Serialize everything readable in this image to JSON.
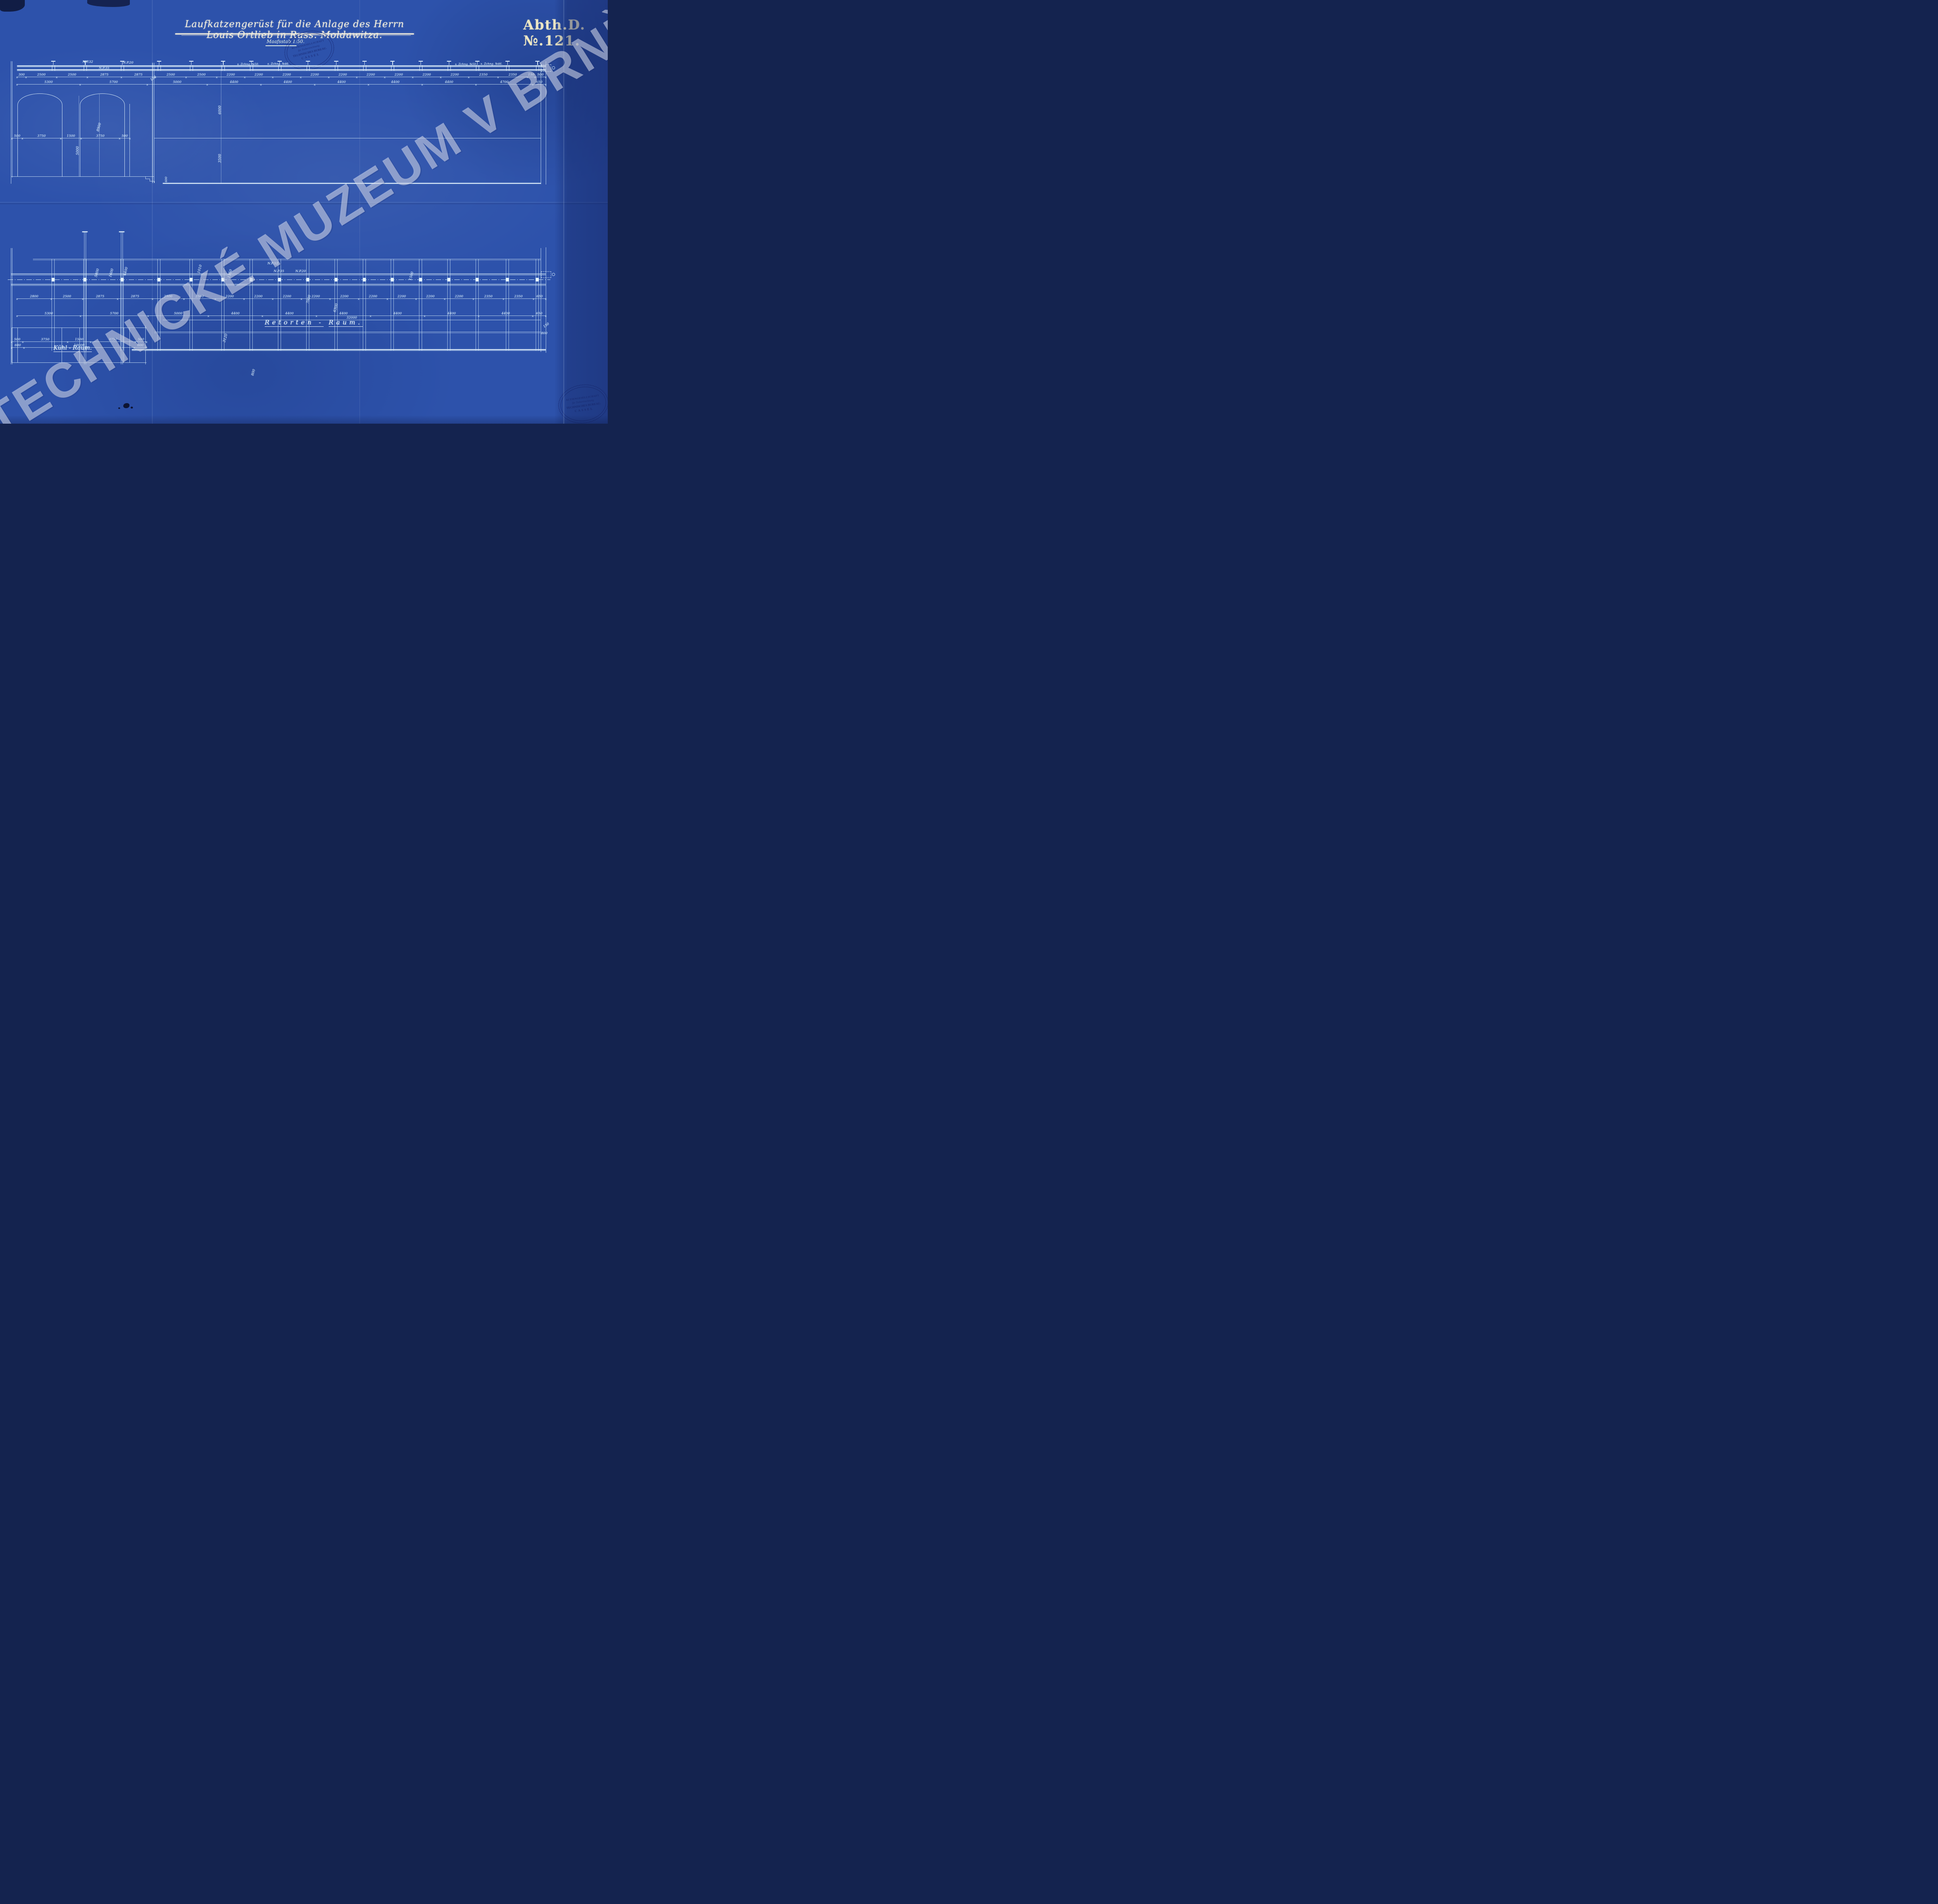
{
  "page": {
    "title": "Laufkatzengerüst für die Anlage des Herrn Louis Ortlieb in Russ. Moldawitza.",
    "drawing_number": "Abth.D.№.121.",
    "scale_note": "Maafsstab 1:50.",
    "watermark": "TECHNICKÉ MUZEUM V BRNĚ"
  },
  "stamp": {
    "line1": "ACTIENGESELLSCHAFT",
    "line2": "für Trebertrocknung",
    "line3": "TECHNISCHES BUREAU.",
    "line4": "CASSEL"
  },
  "elevation": {
    "beam_label_np32": "N.P.32",
    "beam_label_np35": "N.P.35",
    "beam_label_np20": "N.P.20",
    "ref_note_50": "s. Zchng. №50.",
    "ref_note_46": "s. Zchng. №46.",
    "dims_upper": [
      "300",
      "2500",
      "2500",
      "2875",
      "2875",
      "2500",
      "2500",
      "2200",
      "2200",
      "2200",
      "2200",
      "2200",
      "2200",
      "2200",
      "2200",
      "2200",
      "2350",
      "2350",
      "150",
      "500"
    ],
    "dims_lower": [
      "5300",
      "5700",
      "5000",
      "4400",
      "4400",
      "4400",
      "4400",
      "4400",
      "4700",
      "650"
    ],
    "offset_150": "150",
    "height_above_rail": "6000",
    "height_below_rail": "3500",
    "step_height": "600",
    "section": {
      "dims": [
        "500",
        "3750",
        "1500",
        "3750",
        "500"
      ],
      "arch_height": "8900",
      "clear_height": "5000"
    }
  },
  "plan": {
    "beam_label_np32": "N.P.32",
    "beam_label_np35": "N.P.35",
    "beam_label_np20": "N.P.20",
    "dims_upper": [
      "2800",
      "2500",
      "2875",
      "2875",
      "2500",
      "2500",
      "2200",
      "2200",
      "2200",
      "2200",
      "2200",
      "2200",
      "2200",
      "2200",
      "2200",
      "2350",
      "2350",
      "650"
    ],
    "dims_mid": [
      "5300",
      "5700",
      "5000",
      "4400",
      "4400",
      "4400",
      "4400",
      "4400",
      "4400",
      "650"
    ],
    "dims_section": [
      "500",
      "3750",
      "1500",
      "3750",
      "500"
    ],
    "dims_overall": [
      "600",
      "10000",
      "600"
    ],
    "total_length": "32000",
    "rot_5800": "5800",
    "rot_1600": "1600",
    "rot_4400": "4400",
    "rot_1010": "1010",
    "rot_1350": "1350",
    "rot_7000": "7000",
    "rot_6300": "6300",
    "rot_3120": "3120",
    "rot_1500": "1500",
    "rot_800": "800",
    "right_150": "150",
    "right_800": "800"
  },
  "rooms": {
    "left": "Kühl - Raum.",
    "main_word1": "Retorten -",
    "main_word2": "Raum."
  }
}
